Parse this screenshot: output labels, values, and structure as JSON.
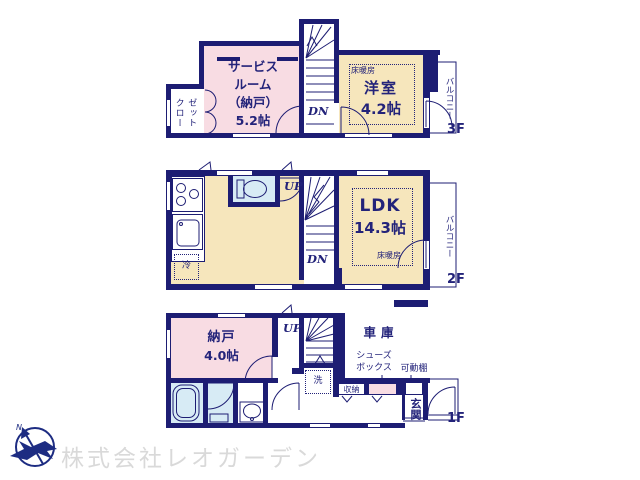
{
  "colors": {
    "wall_navy": "#1d1d73",
    "room_pink": "#f8dce3",
    "room_cream": "#f6e6bc",
    "room_blue": "#d7ebf5",
    "logo_navy": "#1d2c82",
    "company_gray": "#d9d9d9"
  },
  "floor3": {
    "floor_label": "3F",
    "closet_label": "クロー\nゼット",
    "service_room_label": "サービス\nルーム\n（納戸）\n5.2帖",
    "heating_label": "床暖房",
    "western_room_name": "洋室",
    "western_room_size": "4.2帖",
    "stairs_dn": "DN",
    "balcony_label": "バルコニー"
  },
  "floor2": {
    "floor_label": "2F",
    "ldk_name": "LDK",
    "ldk_size": "14.3帖",
    "heating_label": "床暖房",
    "fridge_label": "冷",
    "stairs_up": "UP",
    "stairs_dn": "DN",
    "balcony_label": "バルコニー"
  },
  "floor1": {
    "floor_label": "1F",
    "storage_room_name": "納戸",
    "storage_room_size": "4.0帖",
    "stairs_up": "UP",
    "garage_label": "車庫",
    "washer_label": "洗",
    "closet_label": "収納",
    "shoebox_label": "シューズ\nボックス",
    "shelf_label": "可動棚",
    "entrance_label": "玄関"
  },
  "footer": {
    "logo_n": "N",
    "company_name": "株式会社レオガーデン"
  }
}
